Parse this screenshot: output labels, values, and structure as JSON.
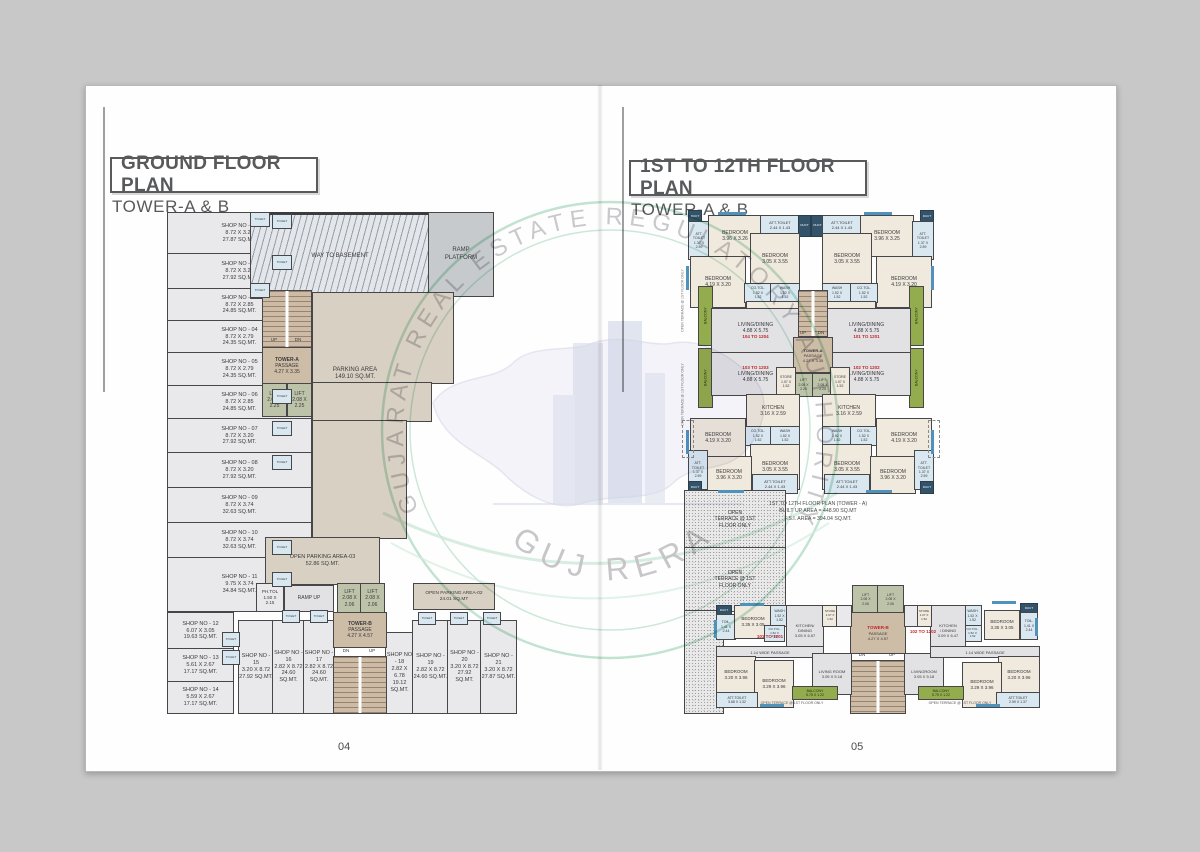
{
  "left_page": {
    "title": "GROUND FLOOR PLAN",
    "subtitle": "TOWER-A & B",
    "page_number": "04"
  },
  "right_page": {
    "title": "1ST TO 12TH FLOOR PLAN",
    "subtitle": "TOWER-A & B",
    "page_number": "05"
  },
  "watermark": {
    "arc_text": "GUJARAT REAL ESTATE REGULATORY AUTHORITY",
    "bottom_text": "GUJ RERA"
  },
  "gf": {
    "shops": [
      "SHOP NO - 01\n8.72 X 3.20\n27.87 SQ.MT.",
      "SHOP NO - 02\n8.72 X 3.20\n27.92 SQ.MT.",
      "SHOP NO - 03\n8.72 X 2.85\n24.85 SQ.MT.",
      "SHOP NO - 04\n8.72 X 2.79\n24.35 SQ.MT.",
      "SHOP NO - 05\n8.72 X 2.79\n24.35 SQ.MT.",
      "SHOP NO - 06\n8.72 X 2.85\n24.85 SQ.MT.",
      "SHOP NO - 07\n8.72 X 3.20\n27.92 SQ.MT.",
      "SHOP NO - 08\n8.72 X 3.20\n27.92 SQ.MT.",
      "SHOP NO - 09\n8.72 X 3.74\n32.63 SQ.MT.",
      "SHOP NO - 10\n8.72 X 3.74\n32.63 SQ.MT.",
      "SHOP NO - 11\n9.75 X 3.74\n34.84 SQ.MT.",
      "SHOP NO - 12\n6.07 X 3.05\n19.63 SQ.MT.",
      "SHOP NO - 13\n5.61 X 2.67\n17.17 SQ.MT.",
      "SHOP NO - 14\n5.59 X 2.67\n17.17 SQ.MT.",
      "SHOP NO - 15\n3.20 X 8.72\n27.92 SQ.MT.",
      "SHOP NO - 16\n2.82 X 8.72\n24.60 SQ.MT.",
      "SHOP NO - 17\n2.82 X 8.72\n24.60 SQ.MT.",
      "SHOP NO - 18\n2.82 X 6.78\n19.12 SQ.MT.",
      "SHOP NO - 19\n2.82 X 8.72\n24.60 SQ.MT.",
      "SHOP NO - 20\n3.20 X 8.72\n27.92 SQ.MT.",
      "SHOP NO - 21\n3.20 X 8.72\n27.87 SQ.MT."
    ],
    "way_to_basement": "WAY TO BASEMENT",
    "ramp_platform": "RAMP\nPLATFORM",
    "parking_area": "PARKING AREA\n149.10 SQ.MT.",
    "open_parking_3": "OPEN PARKING AREA-03\n52.86 SQ.MT.",
    "open_parking_2": "OPEN PARKING AREA-02\n24.01 SQ.MT",
    "ramp_up": "RAMP UP",
    "ph_tol": "PH.TOL\n1.50 X\n2.15",
    "toilet": "TOILET",
    "tower_a": {
      "name": "TOWER-A",
      "passage": "PASSAGE\n4.27 X 3.35",
      "up": "UP",
      "dn": "DN",
      "lift": "LIFT\n2.08 X\n2.25"
    },
    "tower_b": {
      "name": "TOWER-B",
      "passage": "PASSAGE\n4.27 X 4.57",
      "up": "UP",
      "dn": "DN",
      "lift": "LIFT\n2.08 X\n2.06"
    }
  },
  "ff": {
    "note": "1ST TO 12TH FLOOR PLAN (TOWER - A)\nBUILT UP AREA = 448.90 SQ.MT\nF.S.I. AREA = 394.04 SQ.MT.",
    "open_terrace": "OPEN\nTERRACE @ 1ST\nFLOOR ONLY",
    "open_terrace_line": "OPEN TERRACE @ 1ST FLOOR ONLY",
    "units": {
      "u101": "101 TO 1201",
      "u102": "102 TO 1202",
      "u103": "103 TO 1203",
      "u104": "104 TO 1204",
      "b101": "101 TO 1201",
      "b102": "102 TO 1202"
    },
    "rooms": {
      "att_toilet_137": "ATT.\nTOILET\n1.37 X\n2.59",
      "att_toilet_244": "ATT.TOILET\n2.44 X 1.43",
      "bedroom_396_326": "BEDROOM\n3.96 X 3.26",
      "bedroom_396_325": "BEDROOM\n3.96 X 3.25",
      "bedroom_396_320": "BEDROOM\n3.96 X 3.20",
      "bedroom_305": "BEDROOM\n3.05 X 3.55",
      "bedroom_419": "BEDROOM\n4.19 X 3.20",
      "co_tol": "CO.TOL.\n1.52 X\n1.52",
      "wash": "WASH\n1.52 X\n1.52",
      "kitchen": "KITCHEN\n3.16 X 2.59",
      "living_dining": "LIVING/DINING\n4.88 X 5.75",
      "store": "STORE\n1.07 X\n1.52",
      "balcony_v": "BALCONY",
      "duct": "DUCT",
      "lift_225": "LIFT\n2.08 X\n2.25",
      "lift_206": "LIFT\n2.08 X\n2.06",
      "tower_a": "TOWER-A",
      "passage_a": "PASSAGE\n4.27 X 3.35",
      "up": "UP",
      "dn": "DN",
      "toil": "TOIL.\n1.41 X\n2.44",
      "bedroom_335": "BEDROOM\n3.35 X 3.05",
      "kitchen_dining_l": "KITCHEN/\nDINING\n3.05 X 6.57",
      "kitchen_dining_r": "KITCHEN\n/ DINING\n3.09 X 6.47",
      "wide_passage": "1.14 WIDE PASSAGE",
      "bedroom_320": "BEDROOM\n3.20 X 3.96",
      "bedroom_329": "BEDROOM\n3.29 X 3.96",
      "living_room": "LIVING ROOM\n3.05 X 5.18",
      "livingroom": "LIVINGROOM\n3.05 X 5.18",
      "att_toilet_368": "ATT.TOILET\n3.68 X 1.32",
      "att_toilet_259": "ATT.TOILET\n2.59 X 1.37",
      "balcony_h": "BALCONY\n5.75 X 1.22",
      "tower_b": "TOWER-B",
      "passage_b": "PASSAGE\n4.27 X 4.57"
    }
  }
}
